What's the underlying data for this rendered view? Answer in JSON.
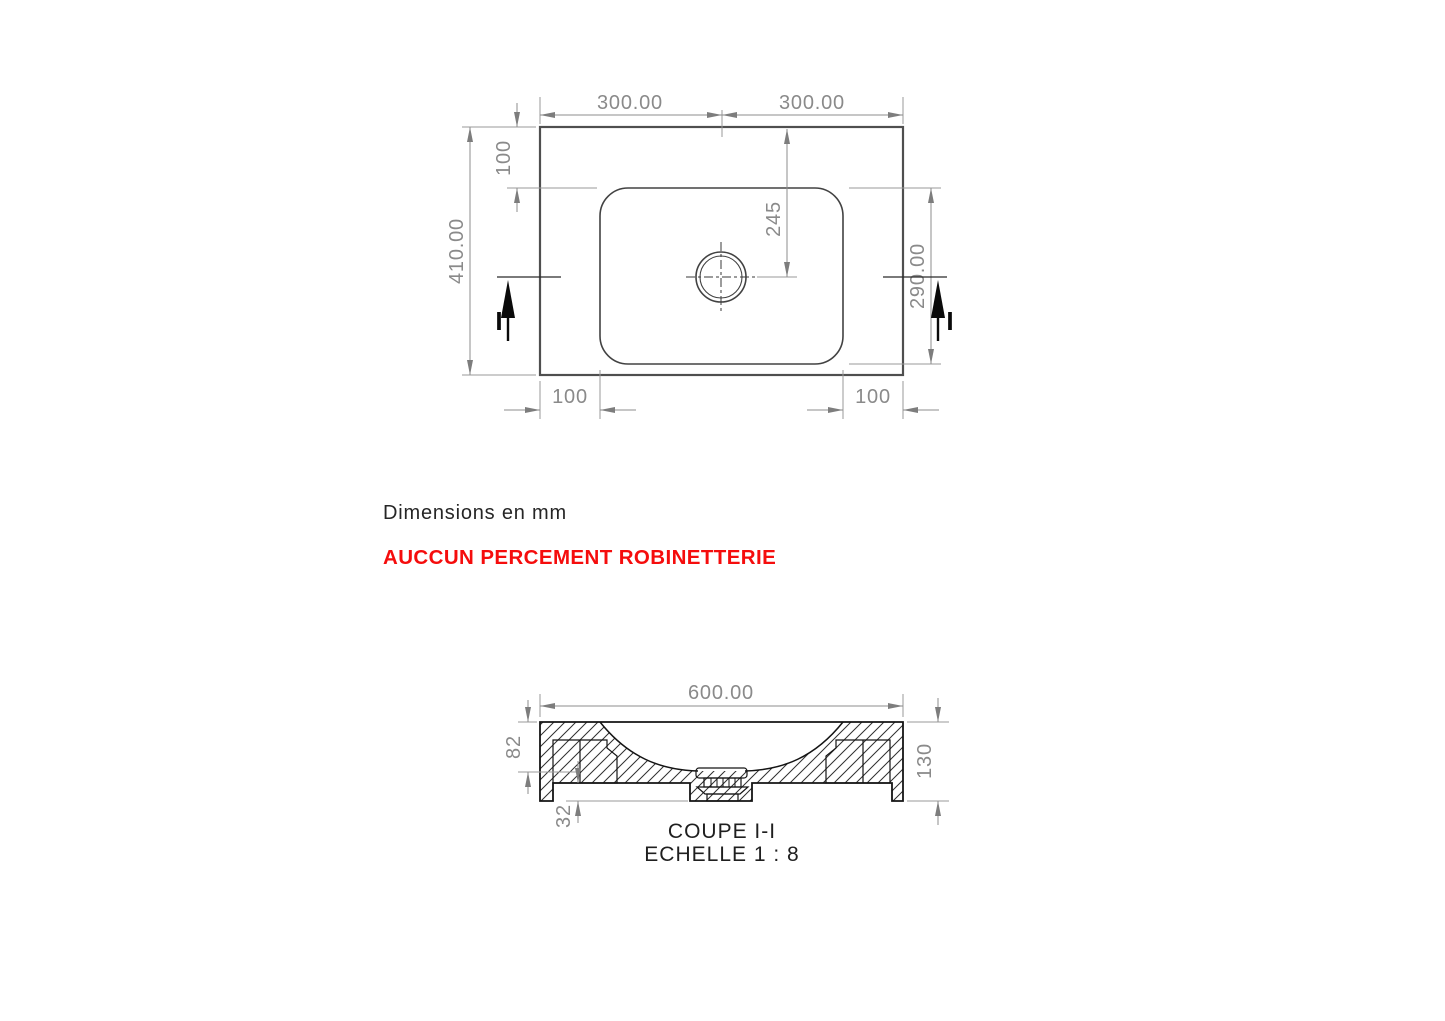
{
  "colors": {
    "warning_red": "#f50d0d",
    "dimension_gray": "#8a8a8a",
    "geometry_dark": "#141414",
    "plan_line_gray": "#4f4f4f",
    "background": "#ffffff"
  },
  "notes": {
    "units": "Dimensions en mm",
    "warning": "AUCCUN PERCEMENT ROBINETTERIE"
  },
  "plan_view": {
    "dimensions": {
      "width_left": "300.00",
      "width_right": "300.00",
      "overall_depth": "410.00",
      "basin_top_offset": "100",
      "drain_center_from_top": "245",
      "basin_depth": "290.00",
      "basin_left_offset": "100",
      "basin_right_offset": "100"
    },
    "section_cut": {
      "label_left": "I",
      "label_right": "I"
    }
  },
  "section_view": {
    "title": "COUPE I-I",
    "scale_note": "ECHELLE 1 : 8",
    "dimensions": {
      "overall_width": "600.00",
      "bowl_depth": "82",
      "edge_thickness": "130",
      "rim_drop": "32"
    }
  }
}
